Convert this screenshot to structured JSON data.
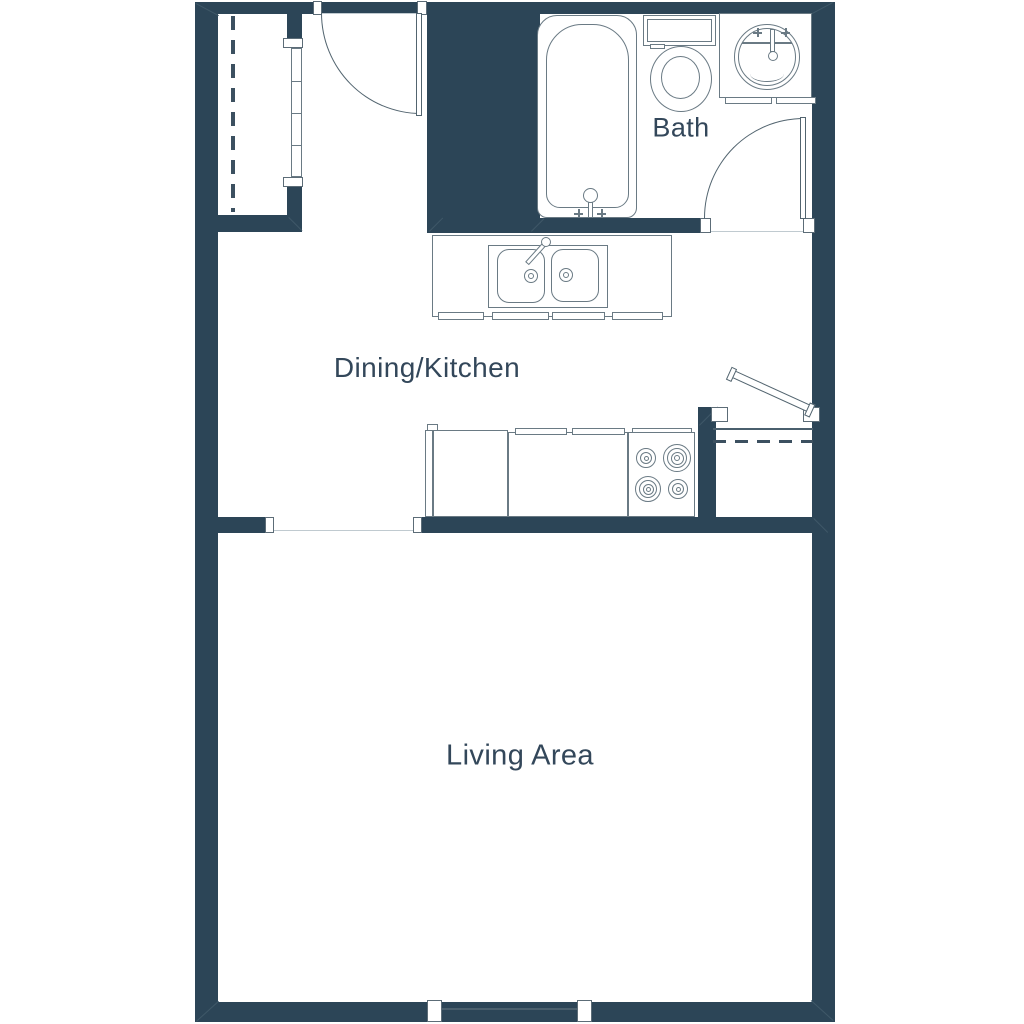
{
  "title": "Studio apartment floor plan",
  "rooms": [
    {
      "name": "bath",
      "label": "Bath"
    },
    {
      "name": "dining-kitchen",
      "label": "Dining/Kitchen"
    },
    {
      "name": "living-area",
      "label": "Living Area"
    }
  ],
  "fixtures": [
    "bathtub",
    "toilet",
    "vanity-round-sink",
    "kitchen-double-sink",
    "refrigerator",
    "range-4-burner",
    "base-cabinets",
    "closet-rod",
    "pantry-shelf"
  ],
  "doors": [
    {
      "name": "entry-door",
      "type": "hinged-90-open"
    },
    {
      "name": "bathroom-door",
      "type": "hinged-90-open"
    },
    {
      "name": "pantry-door",
      "type": "hinged-ajar"
    },
    {
      "name": "closet-sliding-door",
      "type": "sliding-4-panel"
    }
  ],
  "windows": [
    {
      "name": "living-area-window",
      "location": "bottom-wall"
    }
  ],
  "colors": {
    "wall": "#2c4557",
    "fixture_line": "#6a7a84",
    "door_line": "#52646f",
    "label_text": "#33475a",
    "faint_line": "#c0cad0",
    "dashed_line": "#3c5060",
    "window_line": "#4a5f6d",
    "background": "#ffffff"
  }
}
